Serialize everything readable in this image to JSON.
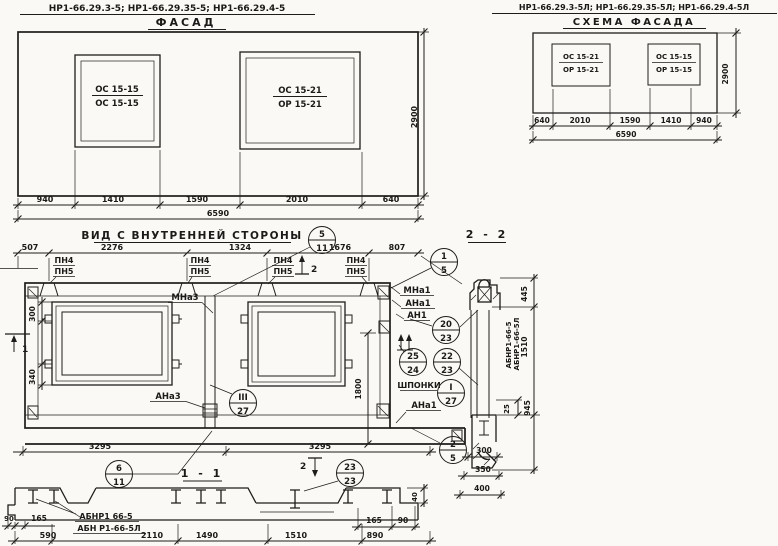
{
  "facade": {
    "code": "НР1-66.29.3-5; НР1-66.29.35-5; НР1-66.29.4-5",
    "title": "ФАСАД",
    "window_left": {
      "top": "ОС 15-15",
      "bottom": "ОС 15-15"
    },
    "window_right": {
      "top": "ОС 15-21",
      "bottom": "ОР 15-21"
    },
    "dims": [
      "940",
      "1410",
      "1590",
      "2010",
      "640"
    ],
    "total": "6590",
    "height": "2900"
  },
  "scheme": {
    "code": "НР1-66.29.3-5Л; НР1-66.29.35-5Л; НР1-66.29.4-5Л",
    "title": "СХЕМА ФАСАДА",
    "window_left": {
      "top": "ОС 15-21",
      "bottom": "ОР 15-21"
    },
    "window_right": {
      "top": "ОС 15-15",
      "bottom": "ОР 15-15"
    },
    "dims": [
      "640",
      "2010",
      "1590",
      "1410",
      "940"
    ],
    "total": "6590",
    "height": "2900"
  },
  "inner": {
    "title": "ВИД С ВНУТРЕННЕЙ СТОРОНЫ",
    "top_dims": [
      "507",
      "2276",
      "1324",
      "1676",
      "807"
    ],
    "pn4": "ПН4",
    "pn5": "ПН5",
    "mna3": "МНа3",
    "ana3": "АНа3",
    "mna1": "МНа1",
    "ana1": "АНа1",
    "an1": "АН1",
    "shponki": "ШПОНКИ",
    "ana1_bottom": "АНа1",
    "dim300": "300",
    "dim340": "340",
    "dim1800": "1800",
    "bottom_dims": [
      "3295",
      "3295"
    ],
    "marker_top": "2",
    "marker_left": "1",
    "marker_bottom": "2",
    "section_title": "1 - 1"
  },
  "balloons": {
    "b5_11": {
      "top": "5",
      "bot": "11"
    },
    "b1_5": {
      "top": "1",
      "bot": "5"
    },
    "b20_23": {
      "top": "20",
      "bot": "23"
    },
    "b25_24": {
      "top": "25",
      "bot": "24"
    },
    "b22_23": {
      "top": "22",
      "bot": "23"
    },
    "bI_27": {
      "top": "I",
      "bot": "27"
    },
    "bIII_27": {
      "top": "III",
      "bot": "27"
    },
    "b2_5": {
      "top": "2",
      "bot": "5"
    },
    "b6_11": {
      "top": "6",
      "bot": "11"
    },
    "b23_23": {
      "top": "23",
      "bot": "23"
    }
  },
  "s22": {
    "title": "2 - 2",
    "mark1": "АБНР1-66-5",
    "mark2": "АБНР1-66-5Л",
    "d445": "445",
    "d1510": "1510",
    "d25": "25",
    "d945": "945",
    "d300": "300",
    "d350": "350",
    "d400": "400"
  },
  "s11": {
    "mark1": "АБНР1 66-5",
    "mark2": "АБН Р1-66-5Л",
    "d90l": "90",
    "d165l": "165",
    "d590": "590",
    "d2110": "2110",
    "d1490": "1490",
    "d1510": "1510",
    "d890": "890",
    "d165r": "165",
    "d90r": "90",
    "d40": "40"
  }
}
